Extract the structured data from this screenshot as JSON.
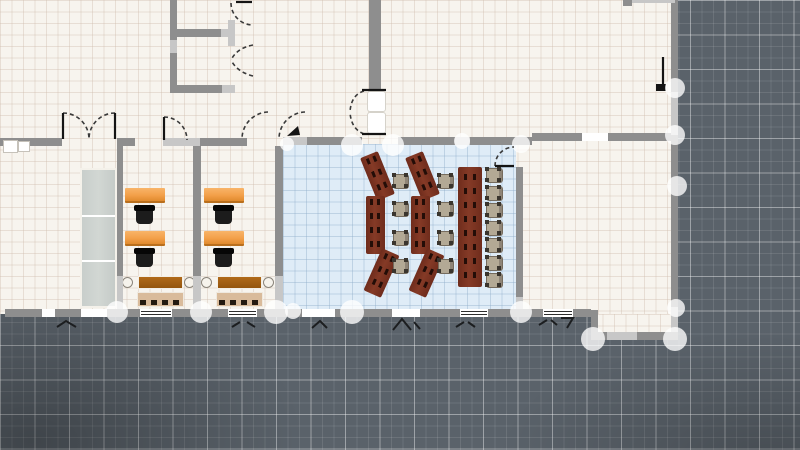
{
  "canvas": {
    "width": 800,
    "height": 450
  },
  "colors": {
    "outside_background": "#5a626a",
    "outside_grid_major": "#aab3b8",
    "floor_cream": "#f7f4ee",
    "floor_grid": "#e9e3d9",
    "room_blue_floor": "#dfecf7",
    "wall_dark": "#8e8e8e",
    "wall_light": "#c7c7c7",
    "node_handle": "rgba(255,255,255,0.78)",
    "desk_orange": "#f3a04a",
    "office_chair_black": "#1c1c1c",
    "training_desk_maroon": "#7b3322",
    "training_chair_tan": "#b3a995",
    "sideboard_brown": "#a05e12",
    "bench_tan": "#d9bb9b",
    "cabinet_gray": "#cdd2cf",
    "door_line": "#3a3a3a"
  },
  "floors": [
    {
      "id": "main-building",
      "kind": "cream",
      "x": 0,
      "y": 0,
      "w": 675,
      "h": 314
    },
    {
      "id": "southeast-extension",
      "kind": "cream",
      "x": 591,
      "y": 314,
      "w": 84,
      "h": 26
    },
    {
      "id": "training-room",
      "kind": "blue",
      "x": 283,
      "y": 144,
      "w": 233,
      "h": 168
    }
  ],
  "walls": [
    {
      "x": 0,
      "y": 138,
      "w": 62,
      "h": 8,
      "tone": "d"
    },
    {
      "x": 117,
      "y": 138,
      "w": 18,
      "h": 8,
      "tone": "d"
    },
    {
      "x": 163,
      "y": 138,
      "w": 37,
      "h": 8,
      "tone": "l"
    },
    {
      "x": 200,
      "y": 138,
      "w": 47,
      "h": 8,
      "tone": "d"
    },
    {
      "x": 283,
      "y": 137,
      "w": 24,
      "h": 8,
      "tone": "l"
    },
    {
      "x": 307,
      "y": 137,
      "w": 55,
      "h": 8,
      "tone": "d"
    },
    {
      "x": 398,
      "y": 137,
      "w": 57,
      "h": 8,
      "tone": "d"
    },
    {
      "x": 455,
      "y": 137,
      "w": 15,
      "h": 8,
      "tone": "l"
    },
    {
      "x": 470,
      "y": 137,
      "w": 62,
      "h": 8,
      "tone": "d"
    },
    {
      "x": 532,
      "y": 133,
      "w": 50,
      "h": 8,
      "tone": "d"
    },
    {
      "x": 608,
      "y": 133,
      "w": 64,
      "h": 8,
      "tone": "d"
    },
    {
      "x": 170,
      "y": 0,
      "w": 7,
      "h": 40,
      "tone": "d"
    },
    {
      "x": 170,
      "y": 40,
      "w": 7,
      "h": 13,
      "tone": "l"
    },
    {
      "x": 170,
      "y": 53,
      "w": 7,
      "h": 40,
      "tone": "d"
    },
    {
      "x": 176,
      "y": 29,
      "w": 45,
      "h": 8,
      "tone": "d"
    },
    {
      "x": 221,
      "y": 29,
      "w": 14,
      "h": 8,
      "tone": "l"
    },
    {
      "x": 228,
      "y": 20,
      "w": 7,
      "h": 26,
      "tone": "l"
    },
    {
      "x": 170,
      "y": 85,
      "w": 52,
      "h": 8,
      "tone": "d"
    },
    {
      "x": 222,
      "y": 85,
      "w": 13,
      "h": 8,
      "tone": "l"
    },
    {
      "x": 369,
      "y": 0,
      "w": 12,
      "h": 89,
      "tone": "d"
    },
    {
      "x": 671,
      "y": 0,
      "w": 7,
      "h": 92,
      "tone": "d"
    },
    {
      "x": 671,
      "y": 92,
      "w": 7,
      "h": 43,
      "tone": "l"
    },
    {
      "x": 671,
      "y": 135,
      "w": 7,
      "h": 172,
      "tone": "d"
    },
    {
      "x": 671,
      "y": 307,
      "w": 7,
      "h": 33,
      "tone": "l"
    },
    {
      "x": 117,
      "y": 146,
      "w": 6,
      "h": 130,
      "tone": "d"
    },
    {
      "x": 117,
      "y": 276,
      "w": 6,
      "h": 33,
      "tone": "l"
    },
    {
      "x": 193,
      "y": 146,
      "w": 8,
      "h": 130,
      "tone": "d"
    },
    {
      "x": 193,
      "y": 276,
      "w": 8,
      "h": 33,
      "tone": "l"
    },
    {
      "x": 275,
      "y": 146,
      "w": 8,
      "h": 130,
      "tone": "d"
    },
    {
      "x": 275,
      "y": 276,
      "w": 8,
      "h": 33,
      "tone": "l"
    },
    {
      "x": 516,
      "y": 167,
      "w": 7,
      "h": 130,
      "tone": "d"
    },
    {
      "x": 516,
      "y": 297,
      "w": 7,
      "h": 15,
      "tone": "l"
    },
    {
      "x": 591,
      "y": 310,
      "w": 7,
      "h": 30,
      "tone": "d"
    },
    {
      "x": 5,
      "y": 309,
      "w": 37,
      "h": 8,
      "tone": "d"
    },
    {
      "x": 55,
      "y": 309,
      "w": 26,
      "h": 8,
      "tone": "d"
    },
    {
      "x": 107,
      "y": 309,
      "w": 33,
      "h": 8,
      "tone": "d"
    },
    {
      "x": 172,
      "y": 309,
      "w": 56,
      "h": 8,
      "tone": "d"
    },
    {
      "x": 257,
      "y": 309,
      "w": 45,
      "h": 8,
      "tone": "d"
    },
    {
      "x": 335,
      "y": 309,
      "w": 57,
      "h": 8,
      "tone": "d"
    },
    {
      "x": 420,
      "y": 309,
      "w": 40,
      "h": 8,
      "tone": "d"
    },
    {
      "x": 488,
      "y": 309,
      "w": 55,
      "h": 8,
      "tone": "d"
    },
    {
      "x": 573,
      "y": 309,
      "w": 18,
      "h": 8,
      "tone": "d"
    },
    {
      "x": 591,
      "y": 332,
      "w": 87,
      "h": 8,
      "tone": "d"
    },
    {
      "x": 607,
      "y": 332,
      "w": 30,
      "h": 8,
      "tone": "l"
    },
    {
      "x": 630,
      "y": 0,
      "w": 45,
      "h": 3,
      "tone": "l"
    },
    {
      "x": 623,
      "y": 0,
      "w": 9,
      "h": 6,
      "tone": "d"
    }
  ],
  "windows": [
    {
      "x": 42,
      "y": 309,
      "w": 13,
      "h": 8,
      "lines": false
    },
    {
      "x": 81,
      "y": 309,
      "w": 26,
      "h": 8,
      "lines": false
    },
    {
      "x": 140,
      "y": 309,
      "w": 32,
      "h": 8,
      "lines": true
    },
    {
      "x": 228,
      "y": 309,
      "w": 29,
      "h": 8,
      "lines": true
    },
    {
      "x": 302,
      "y": 309,
      "w": 33,
      "h": 8,
      "lines": false
    },
    {
      "x": 392,
      "y": 309,
      "w": 28,
      "h": 8,
      "lines": false
    },
    {
      "x": 460,
      "y": 309,
      "w": 28,
      "h": 8,
      "lines": true
    },
    {
      "x": 543,
      "y": 309,
      "w": 30,
      "h": 8,
      "lines": true
    },
    {
      "x": 582,
      "y": 133,
      "w": 26,
      "h": 8,
      "lines": false
    }
  ],
  "nodes": [
    {
      "cx": 117,
      "cy": 312,
      "r": 11
    },
    {
      "cx": 201,
      "cy": 312,
      "r": 11
    },
    {
      "cx": 276,
      "cy": 312,
      "r": 12
    },
    {
      "cx": 293,
      "cy": 311,
      "r": 8
    },
    {
      "cx": 352,
      "cy": 312,
      "r": 12
    },
    {
      "cx": 521,
      "cy": 312,
      "r": 11
    },
    {
      "cx": 287,
      "cy": 144,
      "r": 7
    },
    {
      "cx": 352,
      "cy": 145,
      "r": 11
    },
    {
      "cx": 393,
      "cy": 145,
      "r": 11
    },
    {
      "cx": 462,
      "cy": 141,
      "r": 8
    },
    {
      "cx": 521,
      "cy": 144,
      "r": 9
    },
    {
      "cx": 593,
      "cy": 339,
      "r": 12
    },
    {
      "cx": 675,
      "cy": 339,
      "r": 12
    },
    {
      "cx": 676,
      "cy": 308,
      "r": 9
    },
    {
      "cx": 677,
      "cy": 186,
      "r": 10
    },
    {
      "cx": 675,
      "cy": 135,
      "r": 10
    },
    {
      "cx": 675,
      "cy": 88,
      "r": 10
    }
  ],
  "furniture": {
    "orange_desks": [
      {
        "x": 125,
        "y": 188,
        "w": 40,
        "h": 15
      },
      {
        "x": 125,
        "y": 231,
        "w": 40,
        "h": 15
      },
      {
        "x": 204,
        "y": 188,
        "w": 40,
        "h": 15
      },
      {
        "x": 204,
        "y": 231,
        "w": 40,
        "h": 15
      }
    ],
    "office_chairs": [
      {
        "x": 136,
        "y": 206,
        "w": 17,
        "h": 18
      },
      {
        "x": 136,
        "y": 249,
        "w": 17,
        "h": 18
      },
      {
        "x": 215,
        "y": 206,
        "w": 17,
        "h": 18
      },
      {
        "x": 215,
        "y": 249,
        "w": 17,
        "h": 18
      }
    ],
    "sideboards": [
      {
        "x": 138,
        "y": 276,
        "w": 45,
        "h": 13
      },
      {
        "x": 217,
        "y": 276,
        "w": 45,
        "h": 13
      }
    ],
    "side_tables": [
      {
        "x": 122,
        "y": 277,
        "w": 11,
        "h": 11
      },
      {
        "x": 184,
        "y": 277,
        "w": 11,
        "h": 11
      },
      {
        "x": 201,
        "y": 277,
        "w": 11,
        "h": 11
      },
      {
        "x": 263,
        "y": 277,
        "w": 11,
        "h": 11
      }
    ],
    "benches": [
      {
        "x": 137,
        "y": 292,
        "w": 47,
        "h": 15
      },
      {
        "x": 216,
        "y": 292,
        "w": 47,
        "h": 15
      }
    ],
    "cabinet": {
      "x": 80,
      "y": 168,
      "w": 37,
      "h": 140
    },
    "training_desk_segments": [
      {
        "cx": 377,
        "cy": 176,
        "w": 19,
        "h": 46,
        "rot": -22
      },
      {
        "cx": 375,
        "cy": 225,
        "w": 19,
        "h": 58,
        "rot": 0
      },
      {
        "cx": 381,
        "cy": 273,
        "w": 19,
        "h": 46,
        "rot": 24
      },
      {
        "cx": 422,
        "cy": 176,
        "w": 19,
        "h": 46,
        "rot": -22
      },
      {
        "cx": 420,
        "cy": 225,
        "w": 19,
        "h": 58,
        "rot": 0
      },
      {
        "cx": 426,
        "cy": 273,
        "w": 19,
        "h": 46,
        "rot": 24
      },
      {
        "cx": 470,
        "cy": 227,
        "w": 24,
        "h": 120,
        "rot": 0
      }
    ],
    "training_chairs": [
      {
        "x": 393,
        "y": 174,
        "w": 16,
        "h": 15
      },
      {
        "x": 393,
        "y": 202,
        "w": 16,
        "h": 15
      },
      {
        "x": 393,
        "y": 231,
        "w": 16,
        "h": 15
      },
      {
        "x": 393,
        "y": 259,
        "w": 16,
        "h": 15
      },
      {
        "x": 438,
        "y": 174,
        "w": 16,
        "h": 15
      },
      {
        "x": 438,
        "y": 202,
        "w": 16,
        "h": 15
      },
      {
        "x": 438,
        "y": 231,
        "w": 16,
        "h": 15
      },
      {
        "x": 438,
        "y": 259,
        "w": 16,
        "h": 15
      },
      {
        "x": 486,
        "y": 168,
        "w": 17,
        "h": 15
      },
      {
        "x": 486,
        "y": 186,
        "w": 17,
        "h": 15
      },
      {
        "x": 486,
        "y": 203,
        "w": 17,
        "h": 15
      },
      {
        "x": 486,
        "y": 221,
        "w": 17,
        "h": 15
      },
      {
        "x": 486,
        "y": 238,
        "w": 17,
        "h": 15
      },
      {
        "x": 486,
        "y": 256,
        "w": 17,
        "h": 15
      },
      {
        "x": 486,
        "y": 273,
        "w": 17,
        "h": 15
      }
    ]
  },
  "doors": {
    "arcs": [
      "M 63 113 A 26 26 0 0 1 89 139",
      "M 115 113 A 26 26 0 0 0 89 139",
      "M 164 117 A 23 23 0 0 1 187 140",
      "M 268 112 A 27 27 0 0 0 242 139",
      "M 305 112 A 27 27 0 0 0 279 138",
      "M 364 91 Q 351 95 350 112",
      "M 364 134 Q 351 129 350 112",
      "M 231 3 A 22 22 0 0 0 253 25",
      "M 253 45 Q 237 48 231 60",
      "M 253 76 Q 237 72 231 60",
      "M 495 166 A 19 19 0 0 1 514 147"
    ],
    "leaves": [
      "M 63 113 L 63 139",
      "M 115 113 L 115 139",
      "M 164 117 L 164 140",
      "M 236 2 L 252 2",
      "M 495 166 L 514 166",
      "M 663 57 L 663 86",
      "M 362 90 L 386 90",
      "M 362 134 L 386 134"
    ],
    "panels": [
      {
        "x": 367,
        "y": 91,
        "w": 19,
        "h": 21
      },
      {
        "x": 367,
        "y": 112,
        "w": 19,
        "h": 22
      }
    ],
    "leaf_triangle": "M 287 136 L 298 126 L 300 135 Z",
    "handle_blob": {
      "x": 656,
      "y": 84,
      "w": 10,
      "h": 7
    }
  },
  "opening_marks": [
    "M 57 327 L 66 321 L 76 327",
    "M 232 327 L 240 322 M 247 322 L 255 327",
    "M 312 328 L 320 321 L 327 328",
    "M 393 330 L 402 319 L 411 330 M 414 322 L 420 329",
    "M 456 327 L 464 322 M 468 322 L 475 327",
    "M 539 325 L 547 320 M 551 320 L 557 325",
    "M 561 318 L 573 318 L 567 328"
  ],
  "fixtures": [
    {
      "x": 3,
      "y": 140,
      "w": 15,
      "h": 13
    },
    {
      "x": 18,
      "y": 141,
      "w": 12,
      "h": 11
    }
  ]
}
